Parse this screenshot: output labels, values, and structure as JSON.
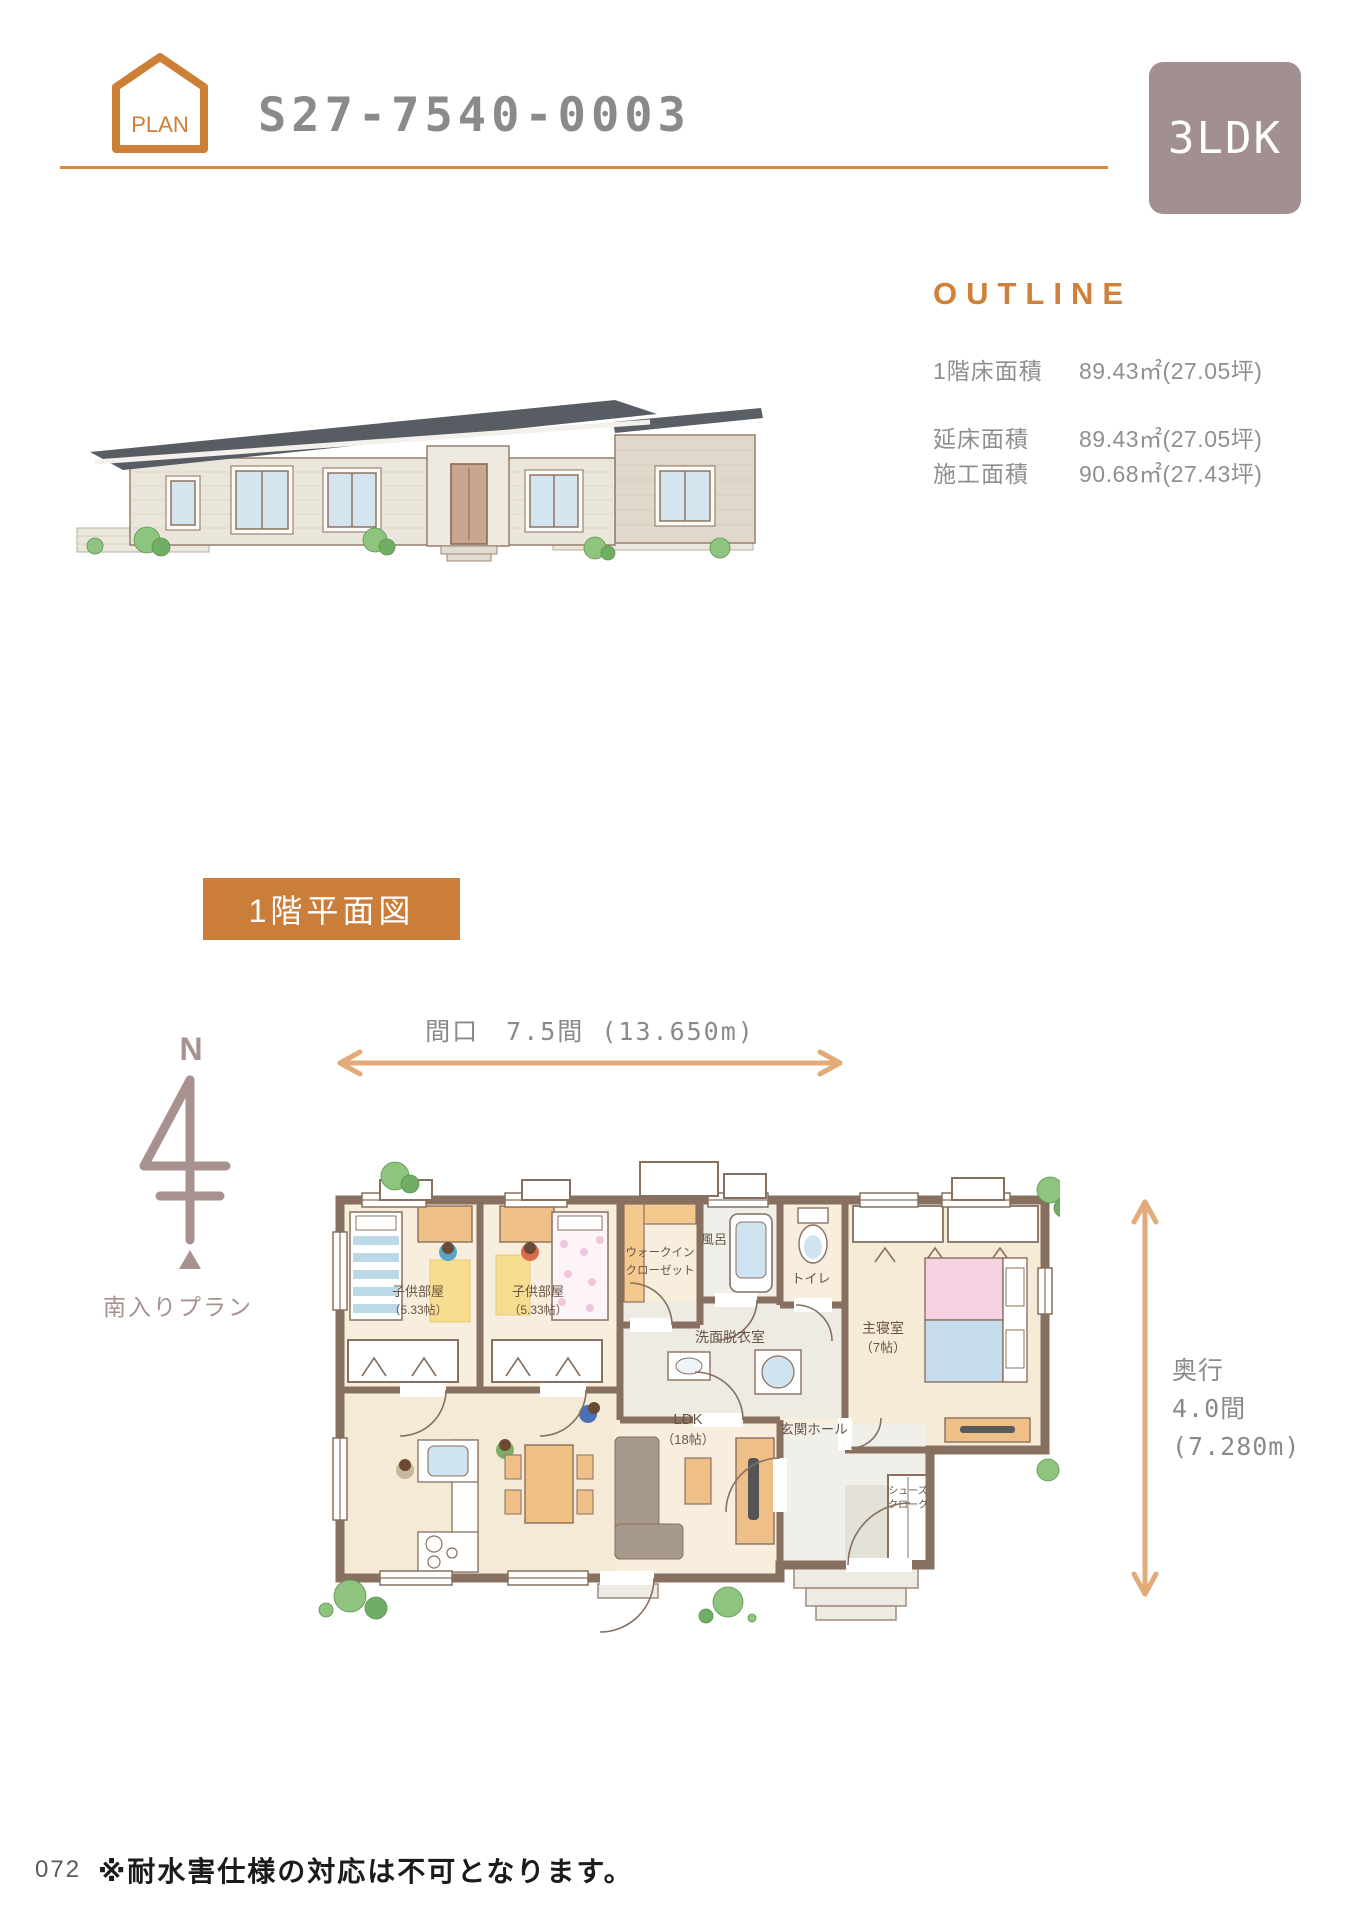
{
  "colors": {
    "accent_orange": "#cc7f35",
    "section_box_orange": "#cb7d3a",
    "type_badge_mauve": "#a29090",
    "dimension_arrow_tan": "#e2ab79",
    "compass_mauve": "#a8928f",
    "wall_brown": "#87705f",
    "title_gray": "#8a8a8a"
  },
  "header": {
    "badge_label": "PLAN",
    "plan_number": "S27-7540-0003",
    "type_badge": "3LDK"
  },
  "outline": {
    "title": "OUTLINE",
    "rows": [
      {
        "label": "1階床面積",
        "value": "89.43㎡(27.05坪)"
      },
      {
        "label": "延床面積",
        "value": "89.43㎡(27.05坪)"
      },
      {
        "label": "施工面積",
        "value": "90.68㎡(27.43坪)"
      }
    ]
  },
  "plan": {
    "section_heading": "1階平面図",
    "compass": {
      "north": "N",
      "entry_direction": "南入りプラン"
    },
    "width_dimension": "間口　7.5間 (13.650m)",
    "depth_dimension": {
      "line1": "奥行",
      "line2": "4.0間",
      "line3": "(7.280m)"
    },
    "rooms": {
      "kids1_name": "子供部屋",
      "kids1_size": "（5.33帖）",
      "kids2_name": "子供部屋",
      "kids2_size": "（5.33帖）",
      "wic_line1": "ウォークイン",
      "wic_line2": "クローゼット",
      "bath": "風呂",
      "toilet": "トイレ",
      "washroom": "洗面脱衣室",
      "master_name": "主寝室",
      "master_size": "（7帖）",
      "ldk_name": "LDK",
      "ldk_size": "（18帖）",
      "entrance_hall": "玄関ホール",
      "shoes_line1": "シューズ",
      "shoes_line2": "クローク"
    }
  },
  "footer": {
    "page_number": "072",
    "note": "※耐水害仕様の対応は不可となります。"
  }
}
